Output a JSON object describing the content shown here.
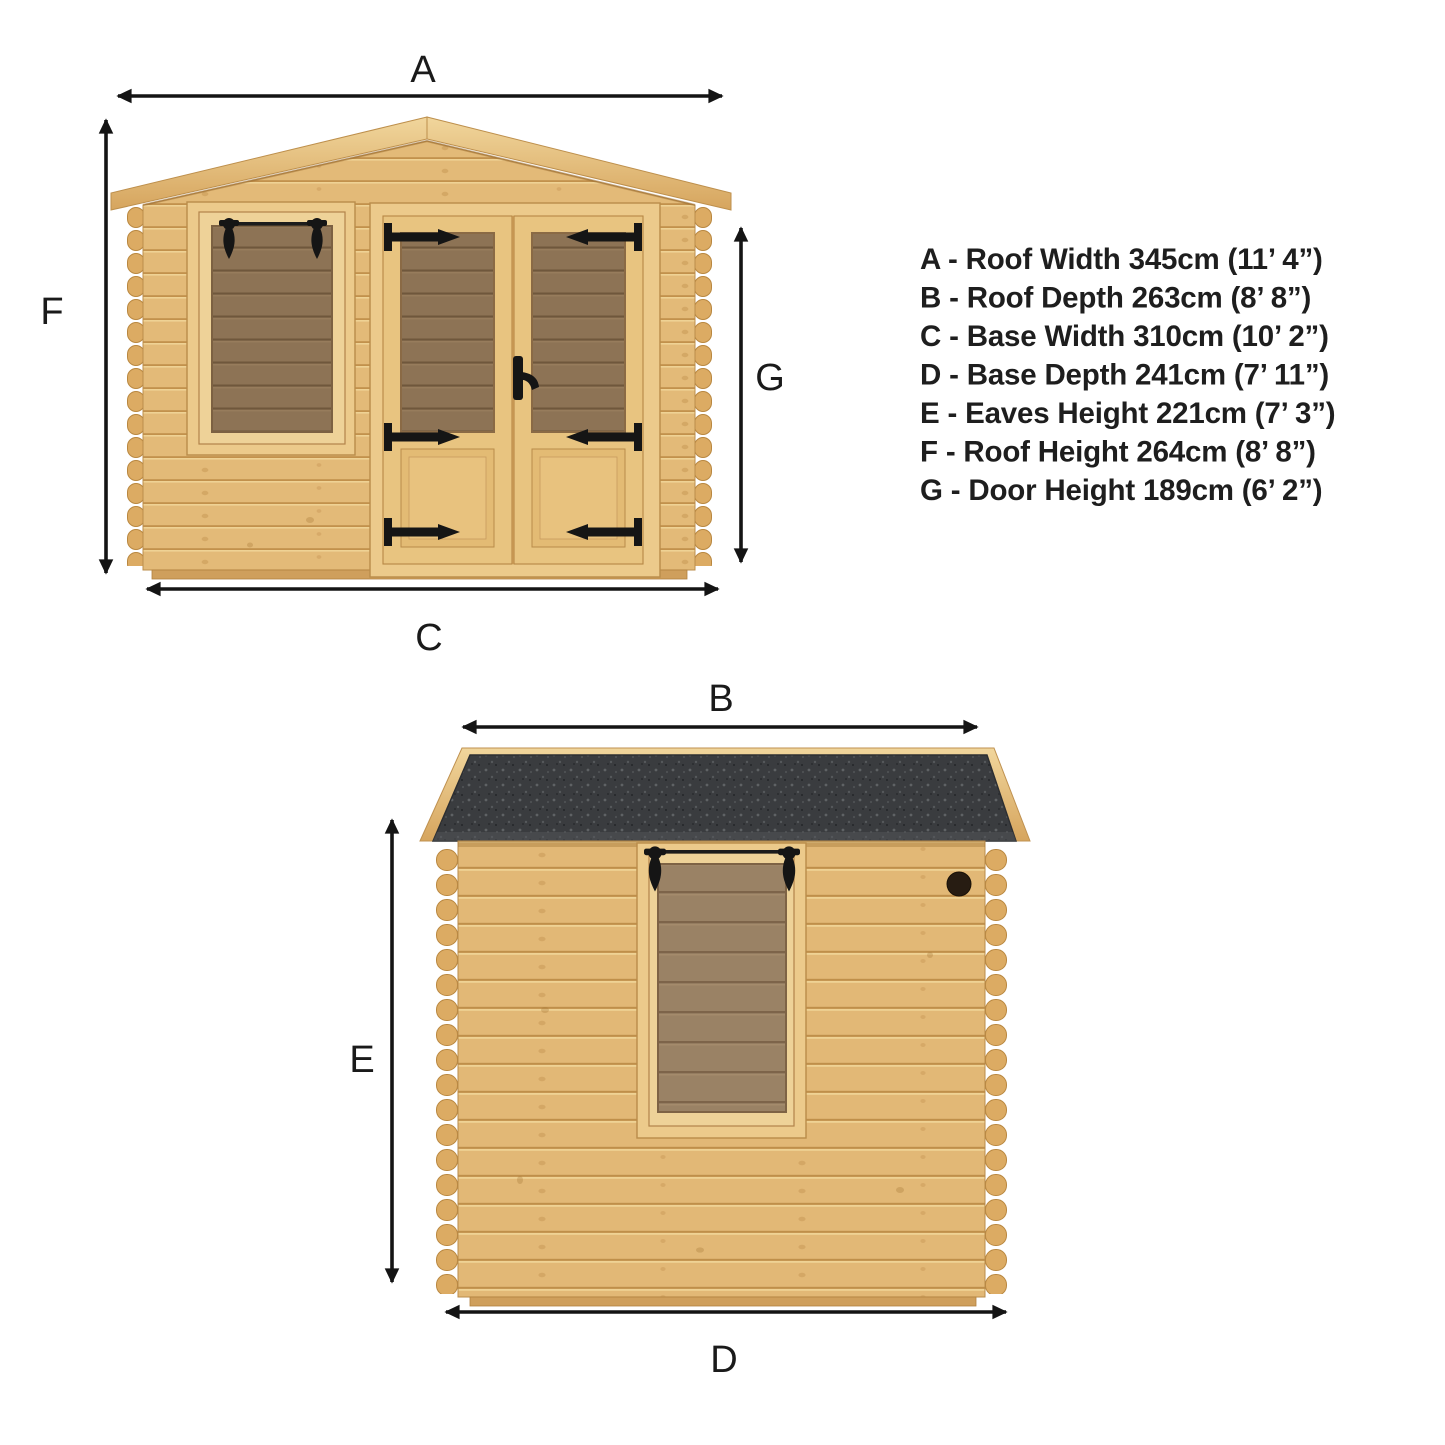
{
  "diagram": {
    "type": "product-dimension-diagram",
    "subject": "wooden log cabin with apex roof",
    "views": {
      "front": {
        "name": "front elevation",
        "dims": {
          "top": "A",
          "left": "F",
          "bottom": "C",
          "right": "G"
        }
      },
      "side": {
        "name": "side elevation",
        "dims": {
          "top": "B",
          "left": "E",
          "bottom": "D"
        }
      }
    }
  },
  "legend": {
    "items": [
      {
        "key": "A",
        "text": "A - Roof Width 345cm (11’ 4”)"
      },
      {
        "key": "B",
        "text": "B - Roof Depth 263cm (8’ 8”)"
      },
      {
        "key": "C",
        "text": "C - Base Width 310cm (10’ 2”)"
      },
      {
        "key": "D",
        "text": "D - Base Depth 241cm (7’ 11”)"
      },
      {
        "key": "E",
        "text": "E - Eaves Height 221cm (7’ 3”)"
      },
      {
        "key": "F",
        "text": "F - Roof Height 264cm (8’ 8”)"
      },
      {
        "key": "G",
        "text": "G - Door Height 189cm (6’ 2”)"
      }
    ]
  },
  "colors": {
    "background": "#ffffff",
    "arrow": "#141414",
    "text": "#1e1e1e",
    "wood": "#e3ba78",
    "wood_line": "#c2914c",
    "wood_trim": "#ecca8b",
    "glass": "#8d7355",
    "glass_side": "#9a8265",
    "roof_felt": "#3a3c3f",
    "hardware": "#151515"
  }
}
